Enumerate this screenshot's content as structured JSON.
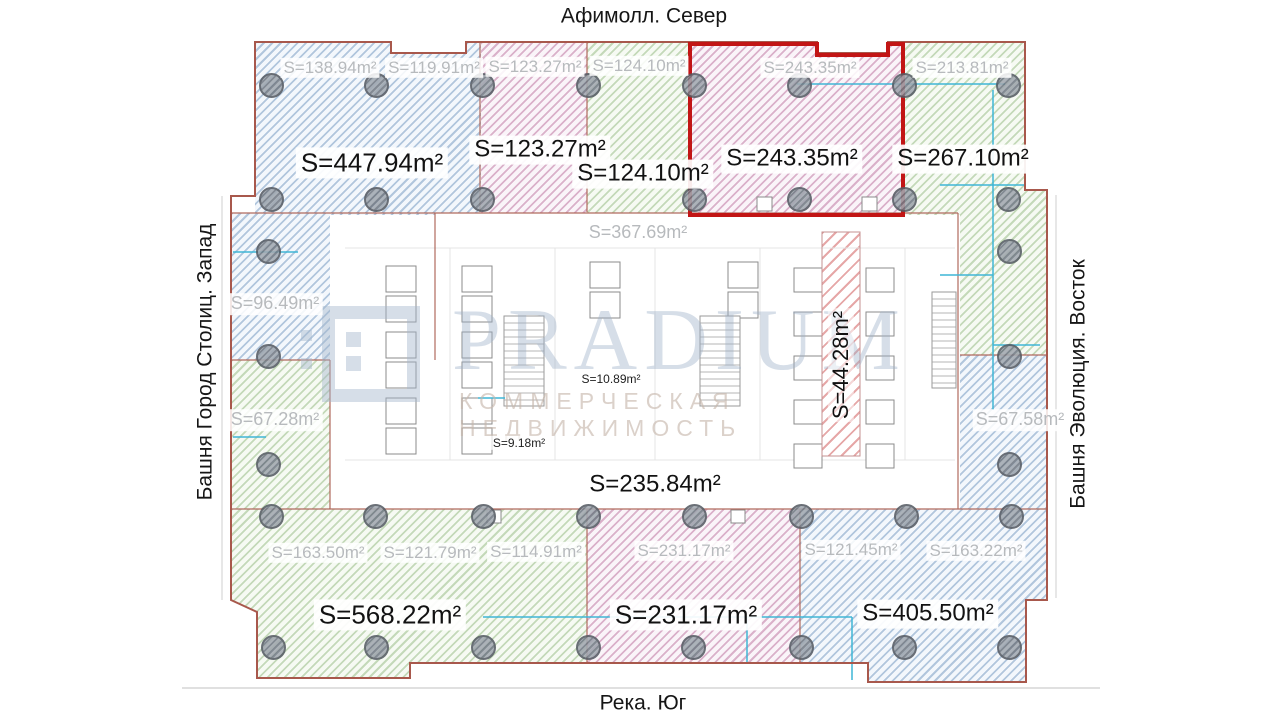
{
  "orientation": {
    "north": "Афимолл. Север",
    "south": "Река. Юг",
    "west": "Башня Город Столиц. Запад",
    "east": "Башня Эволюция. Восток"
  },
  "watermark": {
    "brand": "PRADIUM",
    "tagline": "КОММЕРЧЕСКАЯ НЕДВИЖИМОСТЬ"
  },
  "selected_unit": {
    "label": "S=243.35m²",
    "outline_color": "#c21515"
  },
  "areas": {
    "top_left": "S=447.94m²",
    "top_pink": "S=123.27m²",
    "top_green": "S=124.10m²",
    "selected": "S=243.35m²",
    "top_right": "S=267.10m²",
    "west_blue": "S=96.49m²",
    "west_green": "S=67.28m²",
    "east_blue": "S=67.58m²",
    "core_top": "S=367.69m²",
    "core_small_a": "S=10.89m²",
    "core_small_b": "S=9.18m²",
    "core_bottom": "S=235.84m²",
    "core_shaft": "S=44.28m²",
    "bottom_left": "S=568.22m²",
    "bottom_center": "S=231.17m²",
    "bottom_right": "S=405.50m²"
  },
  "bays": {
    "t1": "S=138.94m²",
    "t2": "S=119.91m²",
    "t3": "S=123.27m²",
    "t4": "S=124.10m²",
    "t5": "S=243.35m²",
    "t6": "S=213.81m²",
    "b1": "S=163.50m²",
    "b2": "S=121.79m²",
    "b3": "S=114.91m²",
    "b4": "S=231.17m²",
    "b5": "S=121.45m²",
    "b6": "S=163.22m²"
  },
  "colors": {
    "hatch_blue": "#9fbcd8",
    "hatch_pink": "#cfa0bf",
    "hatch_green": "#b5cfa8",
    "selected_red": "#c21515",
    "boundary": "#a8584c",
    "partition_cyan": "#3fb6d6"
  }
}
